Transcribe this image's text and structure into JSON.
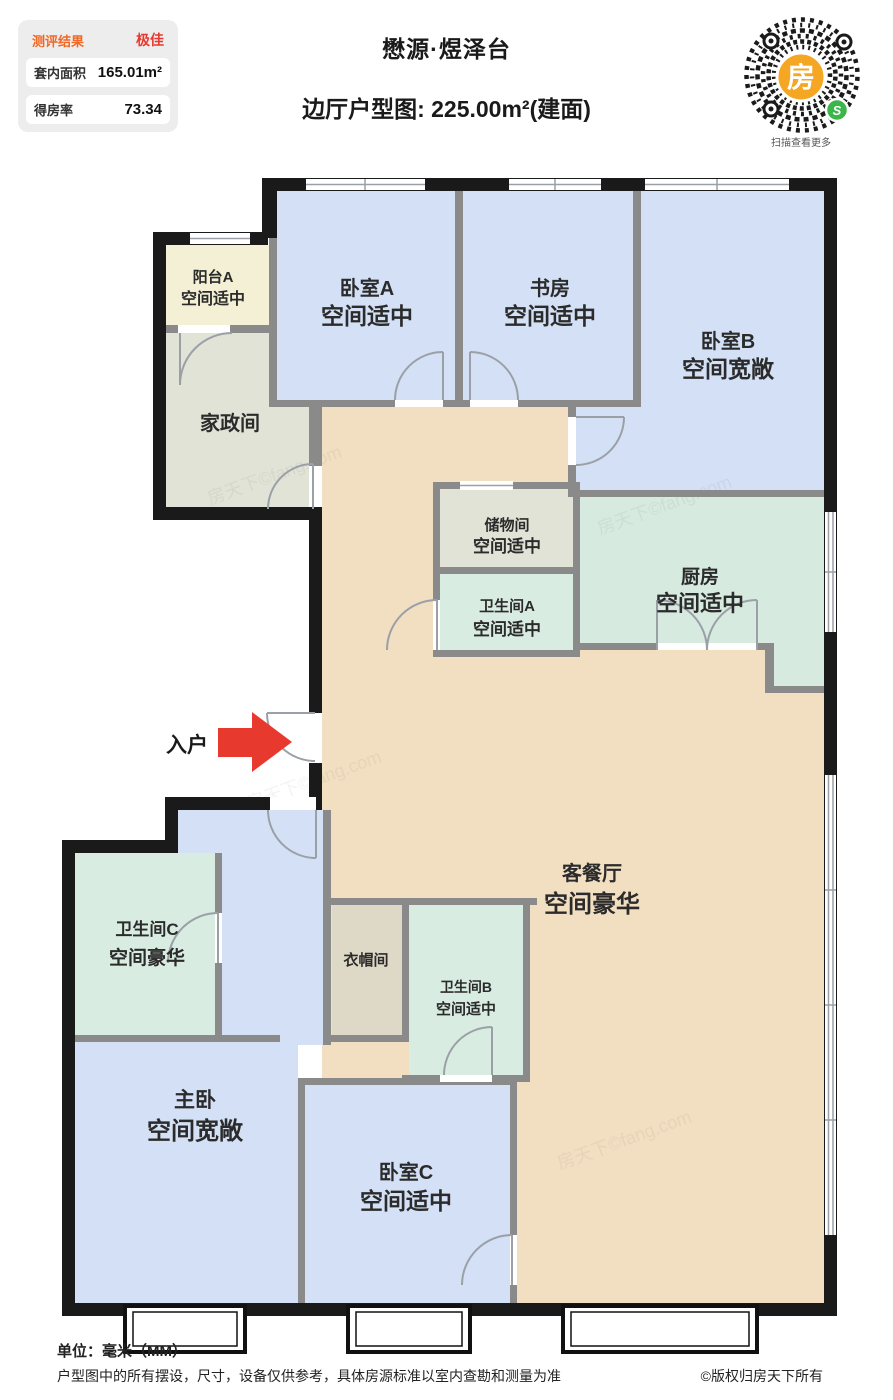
{
  "header": {
    "panel": {
      "row1_label": "测评结果",
      "row1_value": "极佳",
      "row2_label": "套内面积",
      "row2_value": "165.01m²",
      "row3_label": "得房率",
      "row3_value": "73.34"
    },
    "title": "懋源·煜泽台",
    "subtitle": "边厅户型图: 225.00m²(建面)",
    "qr_center_glyph": "房",
    "qr_logo_glyph": "S",
    "qr_caption": "扫描查看更多"
  },
  "plan": {
    "entrance_label": "入户",
    "watermark": "房天下©fang.com",
    "rooms": [
      {
        "name": "阳台A",
        "quality": "空间适中"
      },
      {
        "name": "卧室A",
        "quality": "空间适中"
      },
      {
        "name": "书房",
        "quality": "空间适中"
      },
      {
        "name": "卧室B",
        "quality": "空间宽敞"
      },
      {
        "name": "家政间",
        "quality": ""
      },
      {
        "name": "储物间",
        "quality": "空间适中"
      },
      {
        "name": "卫生间A",
        "quality": "空间适中"
      },
      {
        "name": "厨房",
        "quality": "空间适中"
      },
      {
        "name": "客餐厅",
        "quality": "空间豪华"
      },
      {
        "name": "卫生间C",
        "quality": "空间豪华"
      },
      {
        "name": "衣帽间",
        "quality": ""
      },
      {
        "name": "卫生间B",
        "quality": "空间适中"
      },
      {
        "name": "主卧",
        "quality": "空间宽敞"
      },
      {
        "name": "卧室C",
        "quality": "空间适中"
      }
    ]
  },
  "footer": {
    "unit": "单位：毫米（MM）",
    "disclaimer": "户型图中的所有摆设，尺寸，设备仅供参考，具体房源标准以室内查勘和测量为准",
    "copyright": "©版权归房天下所有"
  },
  "colors": {
    "accent_red": "#e8392e",
    "accent_orange": "#f26722",
    "wall_black": "#1a1a1a",
    "wall_gray": "#8a8a8a",
    "room_blue": "#d3e0f5",
    "room_teal": "#d9ece2",
    "room_tan": "#f2dfc2",
    "room_cream": "#f4f0d5",
    "room_graygreen": "#e1e3d7",
    "qr_orange": "#f5a623",
    "qr_green": "#3cb54a"
  }
}
